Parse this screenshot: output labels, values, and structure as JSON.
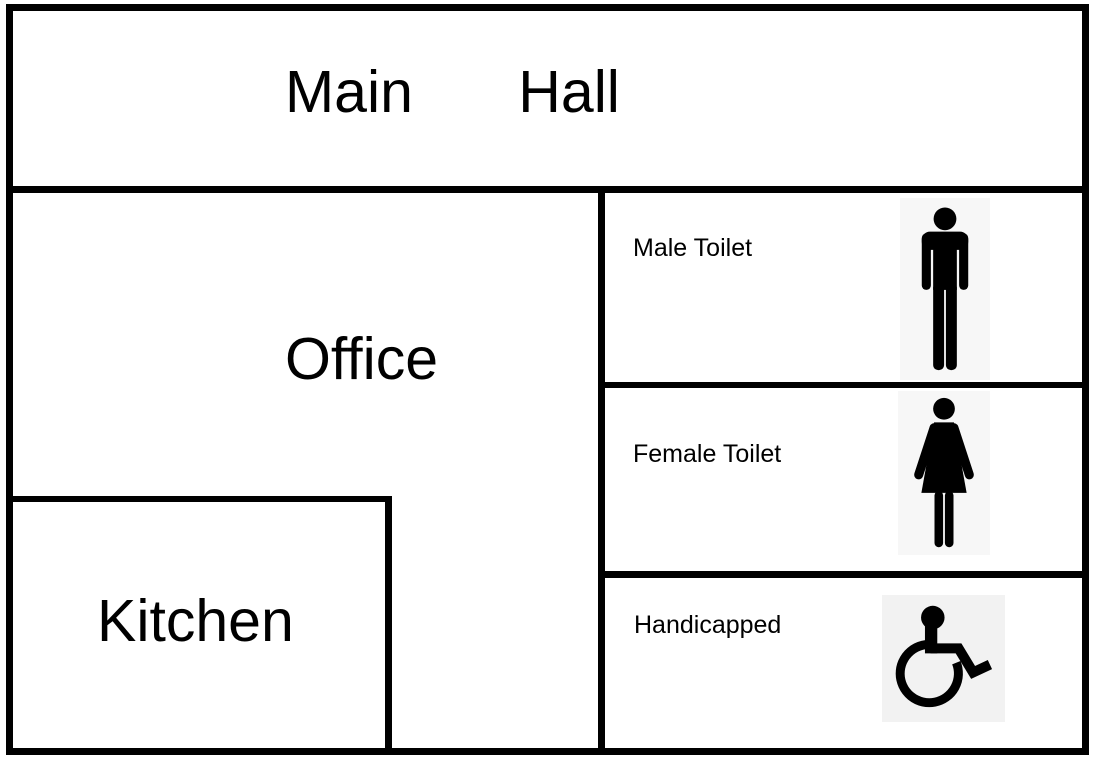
{
  "floorplan": {
    "rooms": {
      "main_hall": {
        "label": "Main Hall"
      },
      "office": {
        "label": "Office"
      },
      "kitchen": {
        "label": "Kitchen"
      },
      "male_toilet": {
        "label": "Male Toilet",
        "icon": "male-figure"
      },
      "female_toilet": {
        "label": "Female Toilet",
        "icon": "female-figure"
      },
      "handicapped": {
        "label": "Handicapped",
        "icon": "wheelchair"
      }
    },
    "colors": {
      "wall": "#000000",
      "floor": "#ffffff",
      "text": "#000000",
      "icon_fill": "#000000",
      "icon_background_light": "#f7f7f7",
      "icon_background_gray": "#f2f2f2"
    }
  }
}
